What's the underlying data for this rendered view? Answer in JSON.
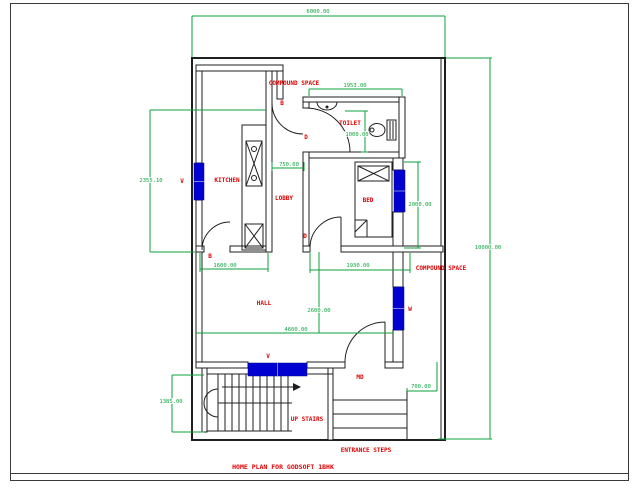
{
  "drawing": {
    "title": "HOME PLAN FOR GODSOFT 1BHK",
    "rooms": {
      "kitchen": "KITCHEN",
      "lobby": "LOBBY",
      "toilet": "TOILET",
      "bed": "BED",
      "hall": "HALL",
      "compound_space_top": "COMPOUND SPACE",
      "compound_space_right": "COMPOUND SPACE"
    },
    "labels": {
      "up_stairs": "UP STAIRS",
      "entrance_steps": "ENTRANCE STEPS",
      "main_door": "MD",
      "door": "D",
      "door_b": "B",
      "ventilator": "V",
      "window": "W"
    },
    "dimensions": {
      "plot_width": "6000.00",
      "plot_height": "10000.00",
      "kitchen_side": "2355.10",
      "kitchen_width": "1600.00",
      "lobby_width": "750.00",
      "toilet_width": "1953.00",
      "toilet_height": "1000.00",
      "bed_height": "2000.00",
      "bed_width": "1930.00",
      "hall_height": "2600.00",
      "hall_width": "4600.00",
      "stair_height": "1385.00",
      "entrance_width": "700.00"
    },
    "colors": {
      "wall": "#1f1f1f",
      "dimension_green": "#0ca13c",
      "label_red": "#dd0000",
      "window_blue": "#0000d0",
      "background": "#ffffff"
    }
  }
}
